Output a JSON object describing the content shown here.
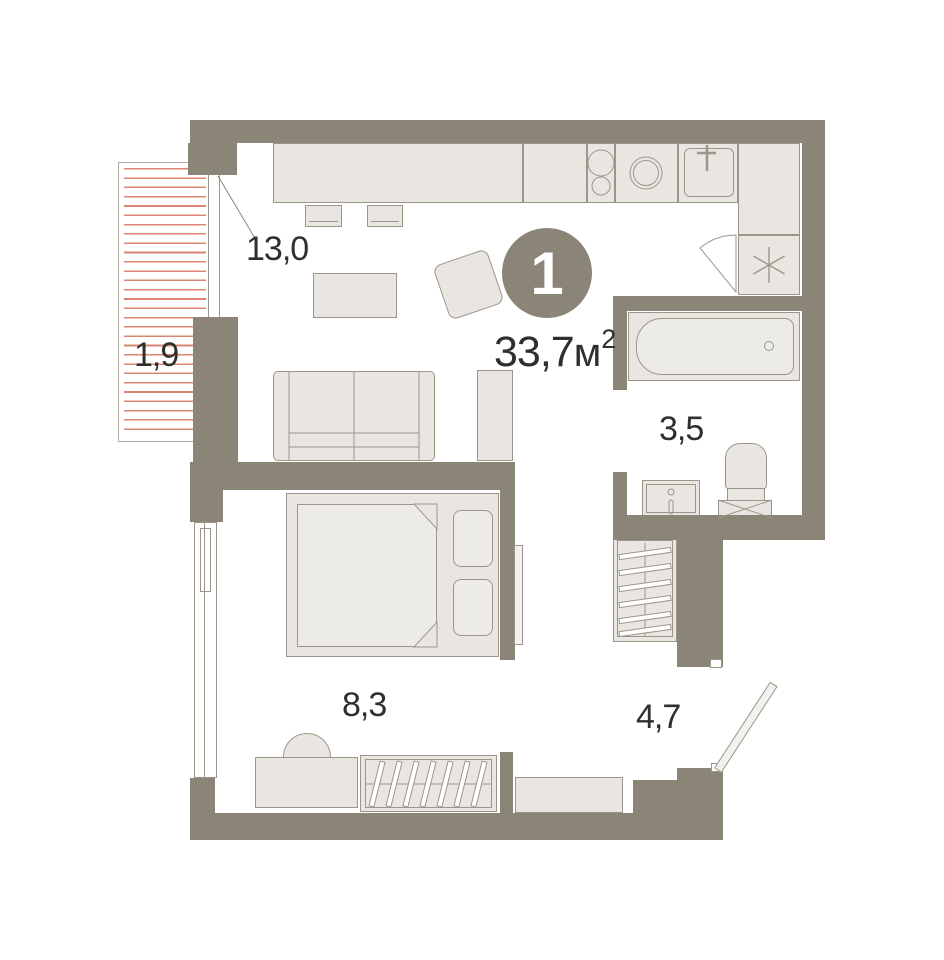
{
  "plan": {
    "badge": "1",
    "total_area": "33,7",
    "area_unit": "м",
    "area_sup": "2",
    "rooms": {
      "living_kitchen": "13,0",
      "balcony": "1,9",
      "bathroom": "3,5",
      "bedroom": "8,3",
      "hallway": "4,7"
    },
    "colors": {
      "wall": "#8b8578",
      "fixture": "#e9e6e1",
      "stroke": "#9c968a",
      "balcony_stripe": "#db8472",
      "text": "#2f2f2c",
      "badge_bg": "#8b8578",
      "badge_text": "#ffffff"
    }
  }
}
